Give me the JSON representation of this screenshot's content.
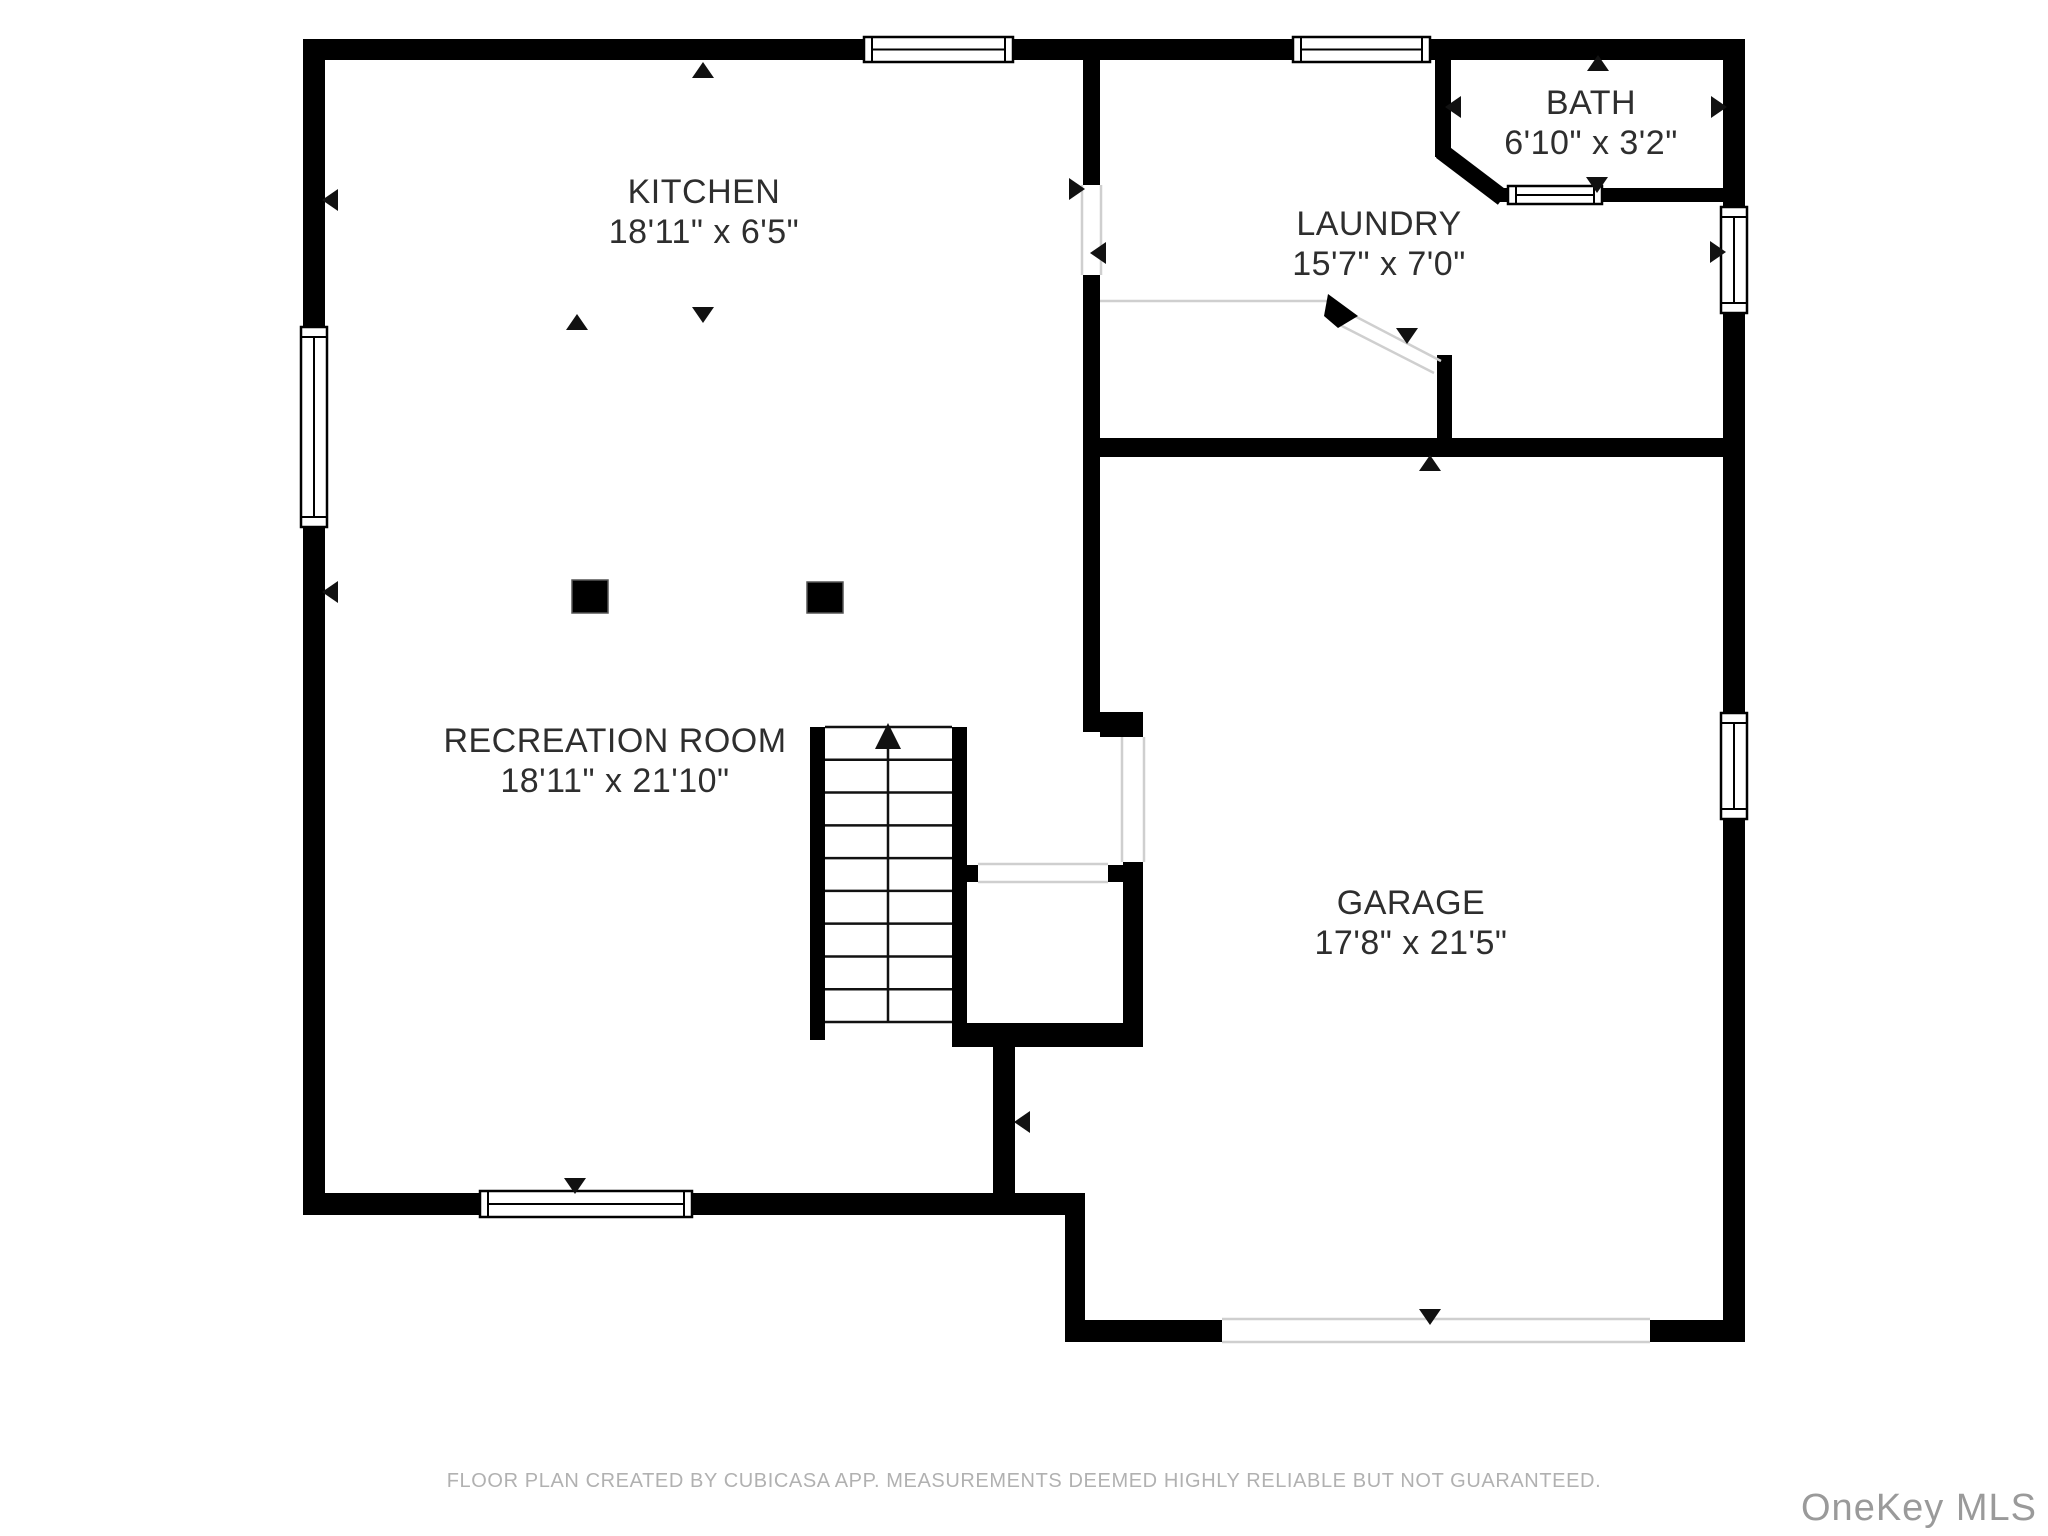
{
  "page": {
    "background": "#ffffff",
    "width": 2048,
    "height": 1536
  },
  "footer": {
    "text": "FLOOR PLAN CREATED BY CUBICASA APP. MEASUREMENTS DEEMED HIGHLY RELIABLE BUT NOT GUARANTEED."
  },
  "watermark": {
    "text": "OneKey MLS"
  },
  "colors": {
    "wall": "#000000",
    "label": "#2e2e2e",
    "window_frame": "#000000",
    "thin_line": "#cfcfcf",
    "footer": "#b1b1b1",
    "watermark": "#9a9a9a",
    "background": "#ffffff"
  },
  "rooms": [
    {
      "id": "kitchen",
      "name": "KITCHEN",
      "dims": "18'11\" x 6'5\"",
      "cx": 704,
      "cy": 212
    },
    {
      "id": "laundry",
      "name": "LAUNDRY",
      "dims": "15'7\" x 7'0\"",
      "cx": 1379,
      "cy": 244
    },
    {
      "id": "bath",
      "name": "BATH",
      "dims": "6'10\" x 3'2\"",
      "cx": 1591,
      "cy": 123
    },
    {
      "id": "recreation-room",
      "name": "RECREATION ROOM",
      "dims": "18'11\" x 21'10\"",
      "cx": 615,
      "cy": 761
    },
    {
      "id": "garage",
      "name": "GARAGE",
      "dims": "17'8\" x 21'5\"",
      "cx": 1411,
      "cy": 923
    }
  ],
  "geometry": {
    "walls": [
      [
        303,
        39,
        1442,
        21
      ],
      [
        303,
        39,
        22,
        1176
      ],
      [
        1723,
        39,
        22,
        1303
      ],
      [
        303,
        1193,
        782,
        22
      ],
      [
        1065,
        1215,
        20,
        127
      ],
      [
        1085,
        1320,
        137,
        22
      ],
      [
        1650,
        1320,
        95,
        22
      ],
      [
        1083,
        60,
        17,
        125
      ],
      [
        1083,
        275,
        17,
        457
      ],
      [
        1100,
        712,
        43,
        25
      ],
      [
        1098,
        438,
        647,
        19
      ],
      [
        1435,
        39,
        16,
        118
      ],
      [
        1494,
        188,
        14,
        14
      ],
      [
        1602,
        188,
        121,
        14
      ],
      [
        1437,
        355,
        15,
        83
      ],
      [
        810,
        727,
        15,
        313
      ],
      [
        952,
        727,
        15,
        320
      ],
      [
        952,
        1023,
        191,
        24
      ],
      [
        1123,
        862,
        20,
        161
      ],
      [
        963,
        865,
        15,
        17
      ],
      [
        1108,
        865,
        15,
        17
      ],
      [
        993,
        1047,
        22,
        168
      ]
    ],
    "diag_walls": [
      {
        "x1": 1441,
        "y1": 151,
        "x2": 1503,
        "y2": 198,
        "w": 17
      }
    ],
    "windows": [
      {
        "x": 864,
        "y": 37,
        "w": 149,
        "h": 25,
        "o": "h"
      },
      {
        "x": 1293,
        "y": 37,
        "w": 137,
        "h": 25,
        "o": "h"
      },
      {
        "x": 301,
        "y": 327,
        "w": 26,
        "h": 200,
        "o": "v"
      },
      {
        "x": 1721,
        "y": 207,
        "w": 26,
        "h": 106,
        "o": "v"
      },
      {
        "x": 1721,
        "y": 713,
        "w": 26,
        "h": 106,
        "o": "v"
      },
      {
        "x": 1508,
        "y": 186,
        "w": 94,
        "h": 18,
        "o": "h"
      },
      {
        "x": 480,
        "y": 1191,
        "w": 212,
        "h": 26,
        "o": "h"
      }
    ],
    "openings": [
      {
        "x": 1081,
        "y": 185,
        "w": 21,
        "h": 90,
        "o": "v"
      },
      {
        "x": 1121,
        "y": 737,
        "w": 24,
        "h": 125,
        "o": "v"
      },
      {
        "x": 978,
        "y": 863,
        "w": 130,
        "h": 20,
        "o": "h"
      },
      {
        "x": 1222,
        "y": 1318,
        "w": 428,
        "h": 25,
        "o": "h"
      }
    ],
    "thin_lines": [
      {
        "x1": 1100,
        "y1": 301,
        "x2": 1332,
        "y2": 301
      },
      {
        "x1": 1345,
        "y1": 311,
        "x2": 1441,
        "y2": 361
      },
      {
        "x1": 1338,
        "y1": 324,
        "x2": 1434,
        "y2": 373
      }
    ],
    "door_leaf": [
      [
        1328,
        294
      ],
      [
        1358,
        316
      ],
      [
        1338,
        328
      ],
      [
        1324,
        316
      ]
    ],
    "columns": [
      [
        572,
        580,
        36,
        33
      ],
      [
        807,
        582,
        36,
        31
      ]
    ],
    "stairs": {
      "x1": 825,
      "x2": 952,
      "y1": 727,
      "y2": 1022,
      "tread_lines": 10,
      "center_x": 888
    },
    "arrows": [
      {
        "x": 703,
        "y": 70,
        "d": "up"
      },
      {
        "x": 330,
        "y": 200,
        "d": "left"
      },
      {
        "x": 330,
        "y": 592,
        "d": "left"
      },
      {
        "x": 577,
        "y": 322,
        "d": "up"
      },
      {
        "x": 703,
        "y": 315,
        "d": "down"
      },
      {
        "x": 1077,
        "y": 189,
        "d": "right"
      },
      {
        "x": 1098,
        "y": 253,
        "d": "left"
      },
      {
        "x": 1598,
        "y": 63,
        "d": "up"
      },
      {
        "x": 1597,
        "y": 185,
        "d": "down"
      },
      {
        "x": 1453,
        "y": 107,
        "d": "left"
      },
      {
        "x": 1719,
        "y": 107,
        "d": "right"
      },
      {
        "x": 1718,
        "y": 252,
        "d": "right"
      },
      {
        "x": 1407,
        "y": 336,
        "d": "down"
      },
      {
        "x": 1430,
        "y": 463,
        "d": "up"
      },
      {
        "x": 1022,
        "y": 1122,
        "d": "left"
      },
      {
        "x": 575,
        "y": 1186,
        "d": "down"
      },
      {
        "x": 1430,
        "y": 1317,
        "d": "down"
      }
    ]
  }
}
